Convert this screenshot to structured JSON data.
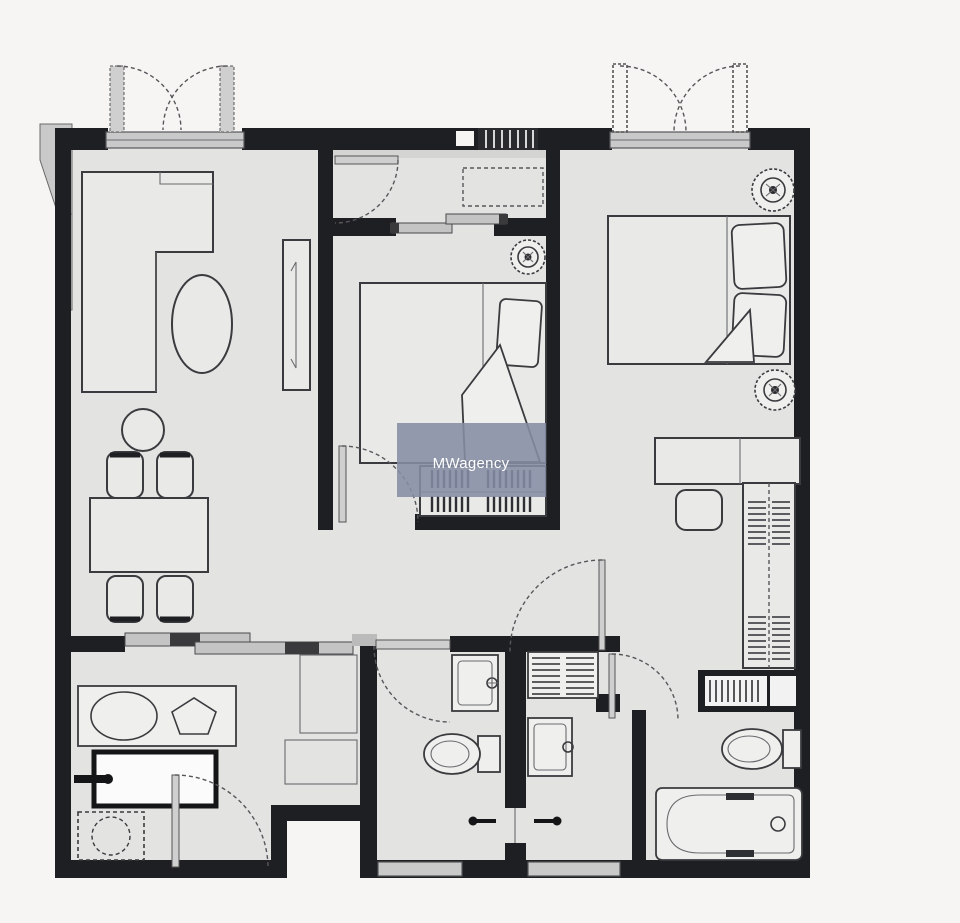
{
  "watermark": {
    "text": "MWagency",
    "background": "#858DA4",
    "text_color": "#FFFFFF"
  },
  "colors": {
    "bg": "#F6F5F4",
    "floor": "#E3E3E2",
    "wall": "#1E1F22",
    "line": "#3A3B3E",
    "furn": "#E9E9E8",
    "fixture": "#EFEFEE",
    "sill": "#C9C9C9",
    "track": "#C4C4C4",
    "wm-bg": "#858DA4",
    "wm-text": "#FFFFFF"
  },
  "plan": {
    "type": "apartment-floor-plan",
    "doors": [
      "french-double-door-left",
      "french-double-door-right",
      "hallway-door",
      "bedroom-2-door",
      "bedroom-1-door",
      "entrance-door",
      "bathroom-a-door",
      "bathroom-c-door",
      "kitchen-sliding-door",
      "bedroom-2-sliding-door"
    ],
    "fixtures": [
      "l-sofa",
      "coffee-table",
      "tv-console",
      "plant",
      "dining-table",
      "dining-chairs",
      "kitchen-sink",
      "oven",
      "washing-machine",
      "bed-double",
      "bed-queen",
      "wardrobe",
      "desk",
      "desk-chair",
      "bathroom-sink",
      "toilet",
      "bathtub",
      "linen-closet"
    ],
    "downlight_count": 3
  }
}
